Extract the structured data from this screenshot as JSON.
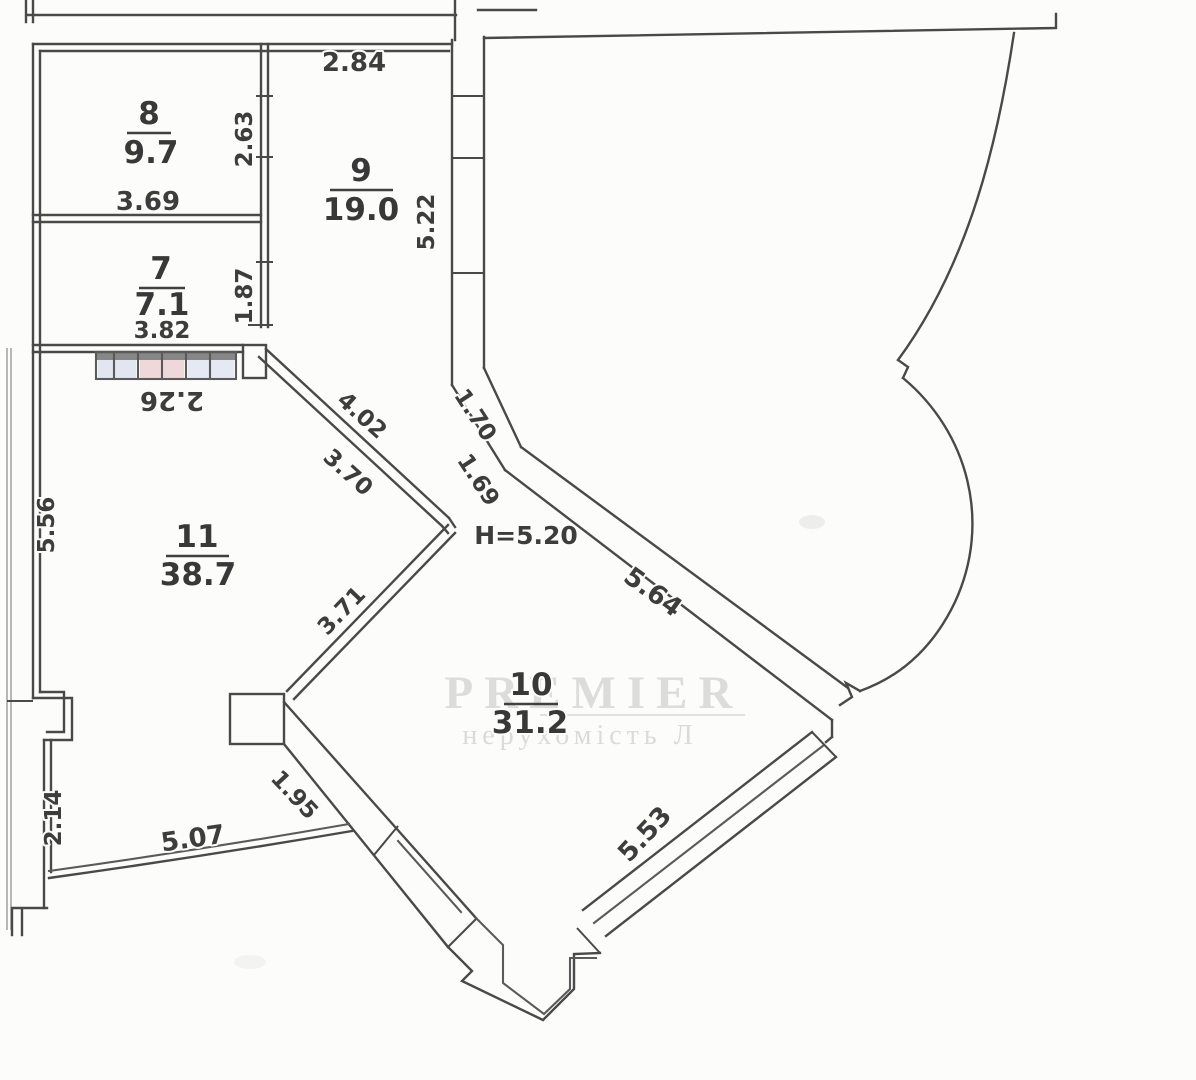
{
  "rooms": [
    {
      "number": "8",
      "area": "9.7"
    },
    {
      "number": "9",
      "area": "19.0"
    },
    {
      "number": "7",
      "area": "7.1"
    },
    {
      "number": "11",
      "area": "38.7"
    },
    {
      "number": "10",
      "area": "31.2"
    }
  ],
  "dims": {
    "d284": "2.84",
    "d263": "2.63",
    "d369": "3.69",
    "d522": "5.22",
    "d187": "1.87",
    "d382": "3.82",
    "d226": "2.26",
    "d556": "5.56",
    "d402": "4.02",
    "d370": "3.70",
    "d170": "1.70",
    "d169": "1.69",
    "d371": "3.71",
    "d564": "5.64",
    "d553": "5.53",
    "d195": "1.95",
    "d507": "5.07",
    "d214": "2.14"
  },
  "height_note": "H=5.20",
  "watermark": {
    "title": "PREMIER",
    "subtitle": "нерухомість Л"
  },
  "colors": {
    "line": "#4a4a4a",
    "text": "#3c3c3c",
    "paper": "#fcfcfb",
    "watermark": "#bcbcbc",
    "radiator_blue": "#aebde0",
    "radiator_red": "#dda2ab"
  }
}
